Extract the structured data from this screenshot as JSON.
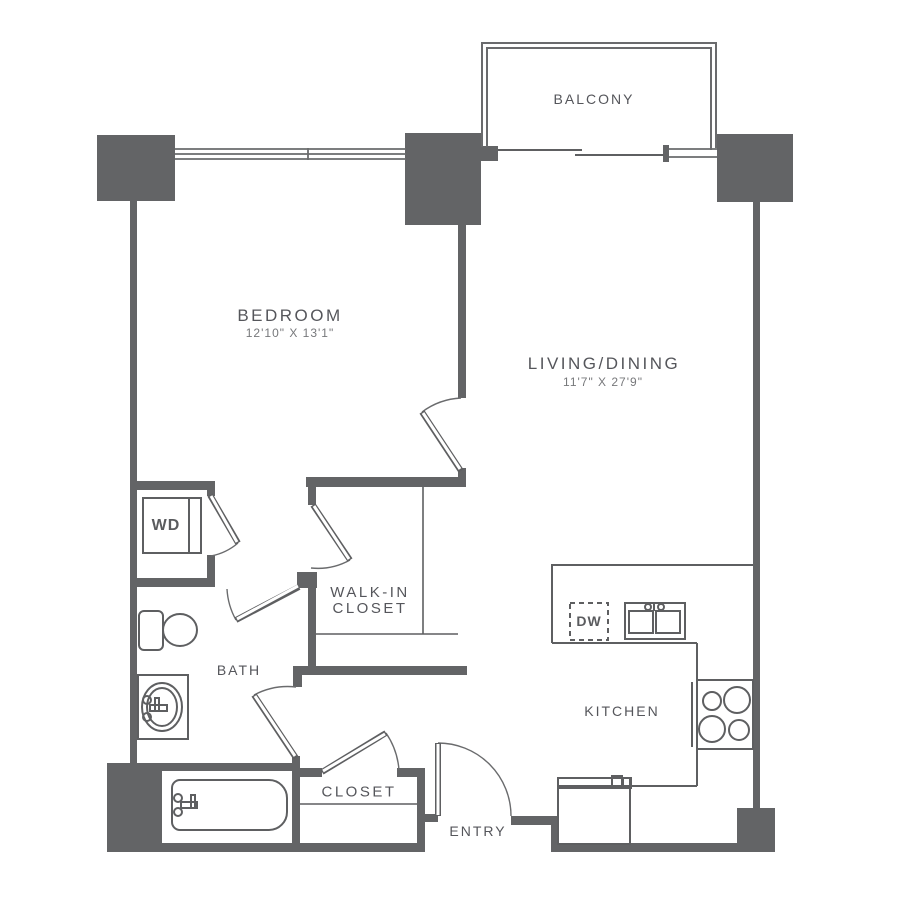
{
  "floorplan": {
    "rooms": {
      "balcony": {
        "label": "BALCONY"
      },
      "bedroom": {
        "label": "BEDROOM",
        "dimensions": "12'10\" X 13'1\""
      },
      "living_dining": {
        "label": "LIVING/DINING",
        "dimensions": "11'7\" X 27'9\""
      },
      "walk_in_closet": {
        "label_line1": "WALK-IN",
        "label_line2": "CLOSET"
      },
      "bath": {
        "label": "BATH"
      },
      "closet": {
        "label": "CLOSET"
      },
      "entry": {
        "label": "ENTRY"
      },
      "kitchen": {
        "label": "KITCHEN"
      }
    },
    "fixtures": {
      "washer_dryer": {
        "label": "WD"
      },
      "dishwasher": {
        "label": "DW"
      }
    },
    "colors": {
      "wall": "#636466",
      "fixture_line": "#5e5f61",
      "label_text": "#55565b",
      "dimension_text": "#77787b",
      "background": "#ffffff"
    }
  }
}
